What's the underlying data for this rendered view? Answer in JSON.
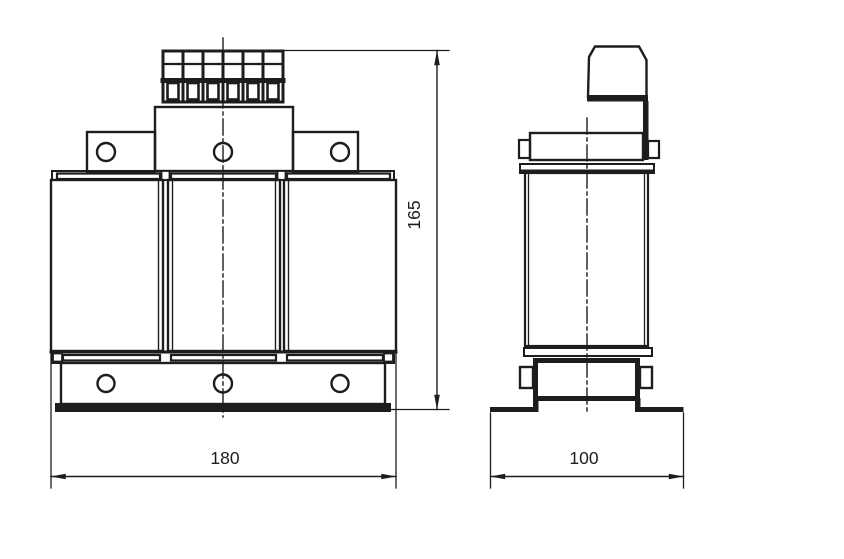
{
  "drawing": {
    "background_color": "#ffffff",
    "line_color": "#1d1d1b",
    "views": {
      "front": {
        "label": "front-view",
        "parts": [
          "terminal-block",
          "center-mount-block",
          "side-bracket-left",
          "side-bracket-right",
          "top-clamp-plate",
          "coil-left",
          "coil-center",
          "coil-right",
          "bottom-clamp-plate",
          "base-box",
          "base-rail"
        ]
      },
      "side": {
        "label": "side-view",
        "parts": [
          "terminal-block-side",
          "terminal-bracket",
          "top-cap",
          "top-flange",
          "coil-body",
          "bottom-flange",
          "clamp-band",
          "mounting-feet"
        ]
      }
    },
    "dimensions": {
      "front_width": "180",
      "front_height": "165",
      "side_width": "100"
    }
  }
}
